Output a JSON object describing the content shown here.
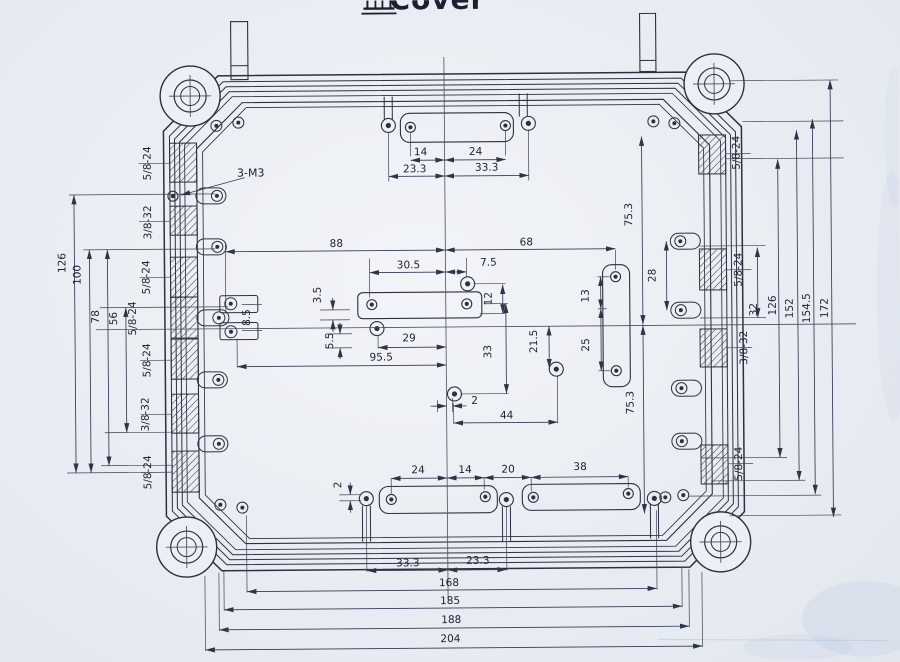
{
  "title": {
    "full": "盖Cover",
    "han": "盖",
    "latin": "Cover"
  },
  "annotations": [
    {
      "t": "3-M3",
      "x": 252,
      "y": 174
    }
  ],
  "threads": {
    "left": [
      {
        "t": "5/8-24",
        "x": 152,
        "y": 161
      },
      {
        "t": "3/8-32",
        "x": 152,
        "y": 220
      },
      {
        "t": "5/8-24",
        "x": 150,
        "y": 275
      },
      {
        "t": "5/8-24",
        "x": 136,
        "y": 316
      },
      {
        "t": "5/8-24",
        "x": 150,
        "y": 358
      },
      {
        "t": "3/8-32",
        "x": 148,
        "y": 412
      },
      {
        "t": "5/8-24",
        "x": 150,
        "y": 470
      }
    ],
    "right": [
      {
        "t": "5/8-24",
        "x": 741,
        "y": 155
      },
      {
        "t": "5/8-24",
        "x": 742,
        "y": 272
      },
      {
        "t": "3/8-32",
        "x": 747,
        "y": 350
      },
      {
        "t": "5/8-24",
        "x": 741,
        "y": 466
      }
    ]
  },
  "dims": [
    {
      "t": "14",
      "x": 422,
      "y": 155
    },
    {
      "t": "24",
      "x": 477,
      "y": 155
    },
    {
      "t": "23.3",
      "x": 416,
      "y": 172
    },
    {
      "t": "33.3",
      "x": 488,
      "y": 171
    },
    {
      "t": "88",
      "x": 337,
      "y": 246
    },
    {
      "t": "68",
      "x": 527,
      "y": 246
    },
    {
      "t": "30.5",
      "x": 409,
      "y": 268
    },
    {
      "t": "7.5",
      "x": 489,
      "y": 266
    },
    {
      "t": "3.5",
      "x": 321,
      "y": 294,
      "r": 1
    },
    {
      "t": "12",
      "x": 492,
      "y": 299,
      "r": 1
    },
    {
      "t": "13",
      "x": 589,
      "y": 297,
      "r": 1
    },
    {
      "t": "28",
      "x": 656,
      "y": 277,
      "r": 1
    },
    {
      "t": "8.5",
      "x": 250,
      "y": 316,
      "r": 1
    },
    {
      "t": "5.5",
      "x": 333,
      "y": 340,
      "r": 1
    },
    {
      "t": "29",
      "x": 409,
      "y": 341
    },
    {
      "t": "95.5",
      "x": 381,
      "y": 360
    },
    {
      "t": "33",
      "x": 491,
      "y": 352,
      "r": 1
    },
    {
      "t": "21.5",
      "x": 537,
      "y": 342,
      "r": 1
    },
    {
      "t": "25",
      "x": 589,
      "y": 346,
      "r": 1
    },
    {
      "t": "2",
      "x": 474,
      "y": 404
    },
    {
      "t": "44",
      "x": 506,
      "y": 419
    },
    {
      "t": "75.3",
      "x": 633,
      "y": 216,
      "r": 1
    },
    {
      "t": "75.3",
      "x": 633,
      "y": 404,
      "r": 1
    },
    {
      "t": "2",
      "x": 340,
      "y": 484,
      "r": 1
    },
    {
      "t": "24",
      "x": 417,
      "y": 473
    },
    {
      "t": "14",
      "x": 464,
      "y": 473
    },
    {
      "t": "20",
      "x": 507,
      "y": 473
    },
    {
      "t": "38",
      "x": 579,
      "y": 471
    },
    {
      "t": "33.3",
      "x": 406,
      "y": 566
    },
    {
      "t": "23.3",
      "x": 476,
      "y": 564
    },
    {
      "t": "168",
      "x": 447,
      "y": 586
    },
    {
      "t": "185",
      "x": 448,
      "y": 604
    },
    {
      "t": "188",
      "x": 449,
      "y": 623
    },
    {
      "t": "204",
      "x": 448,
      "y": 642
    },
    {
      "t": "126",
      "x": 66,
      "y": 260,
      "r": 1
    },
    {
      "t": "100",
      "x": 81,
      "y": 272,
      "r": 1
    },
    {
      "t": "78",
      "x": 99,
      "y": 314,
      "r": 1
    },
    {
      "t": "56",
      "x": 117,
      "y": 316,
      "r": 1
    },
    {
      "t": "32",
      "x": 757,
      "y": 312,
      "r": 1
    },
    {
      "t": "126",
      "x": 776,
      "y": 308,
      "r": 1
    },
    {
      "t": "152",
      "x": 793,
      "y": 311,
      "r": 1
    },
    {
      "t": "154.5",
      "x": 810,
      "y": 311,
      "r": 1
    },
    {
      "t": "172",
      "x": 828,
      "y": 311,
      "r": 1
    }
  ],
  "colors": {
    "paper": "#eceff4",
    "ink": "#2b3140",
    "thin": "#3a4254",
    "dim": "#333b54",
    "text": "#1b2130",
    "artifact": "#aec2de"
  }
}
